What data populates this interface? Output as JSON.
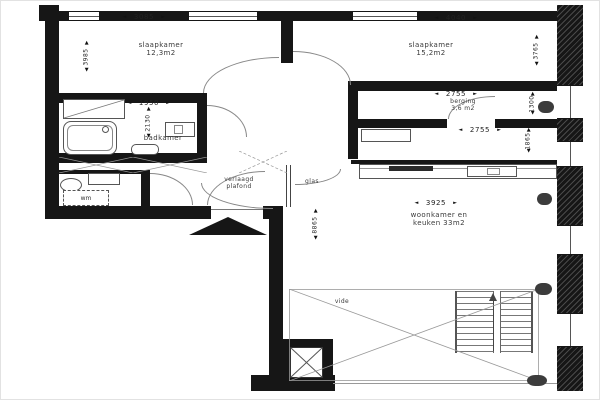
{
  "colors": {
    "wall": "#161616",
    "line": "#888",
    "vent": "#3c3c3c",
    "text": "#3a3a3a"
  },
  "rooms": {
    "bedroom1": {
      "line1": "slaapkamer",
      "line2": "12,3m2"
    },
    "bedroom2": {
      "line1": "slaapkamer",
      "line2": "15,2m2"
    },
    "storage": {
      "line1": "berging",
      "line2": "3,6 m2"
    },
    "bathroom": {
      "label": "badkamer"
    },
    "living": {
      "line1": "woonkamer  en",
      "line2": "keuken  33m2"
    },
    "void": {
      "label": "vide"
    },
    "wc": {
      "washer_label": "wm"
    },
    "hall": {
      "ceiling_line1": "verlaagd",
      "ceiling_line2": "plafond"
    },
    "glass_label": "glas"
  },
  "dims": {
    "bedroom1_width": {
      "value": "3085"
    },
    "bedroom1_depth": {
      "value": "3985"
    },
    "bedroom2_width": {
      "value": "4040"
    },
    "bedroom2_depth": {
      "value": "3765"
    },
    "bathroom_width": {
      "value": "1950"
    },
    "bathroom_depth": {
      "value": "2130"
    },
    "storage_width": {
      "value": "2755"
    },
    "storage_depth": {
      "value": "1300"
    },
    "hall_width": {
      "value": "2755"
    },
    "hall_depth": {
      "value": "1865"
    },
    "living_width": {
      "value": "3925"
    },
    "living_depth": {
      "value": "8865"
    }
  },
  "markers": {
    "left": "◄",
    "right": "►",
    "up": "▲",
    "down": "▼"
  }
}
